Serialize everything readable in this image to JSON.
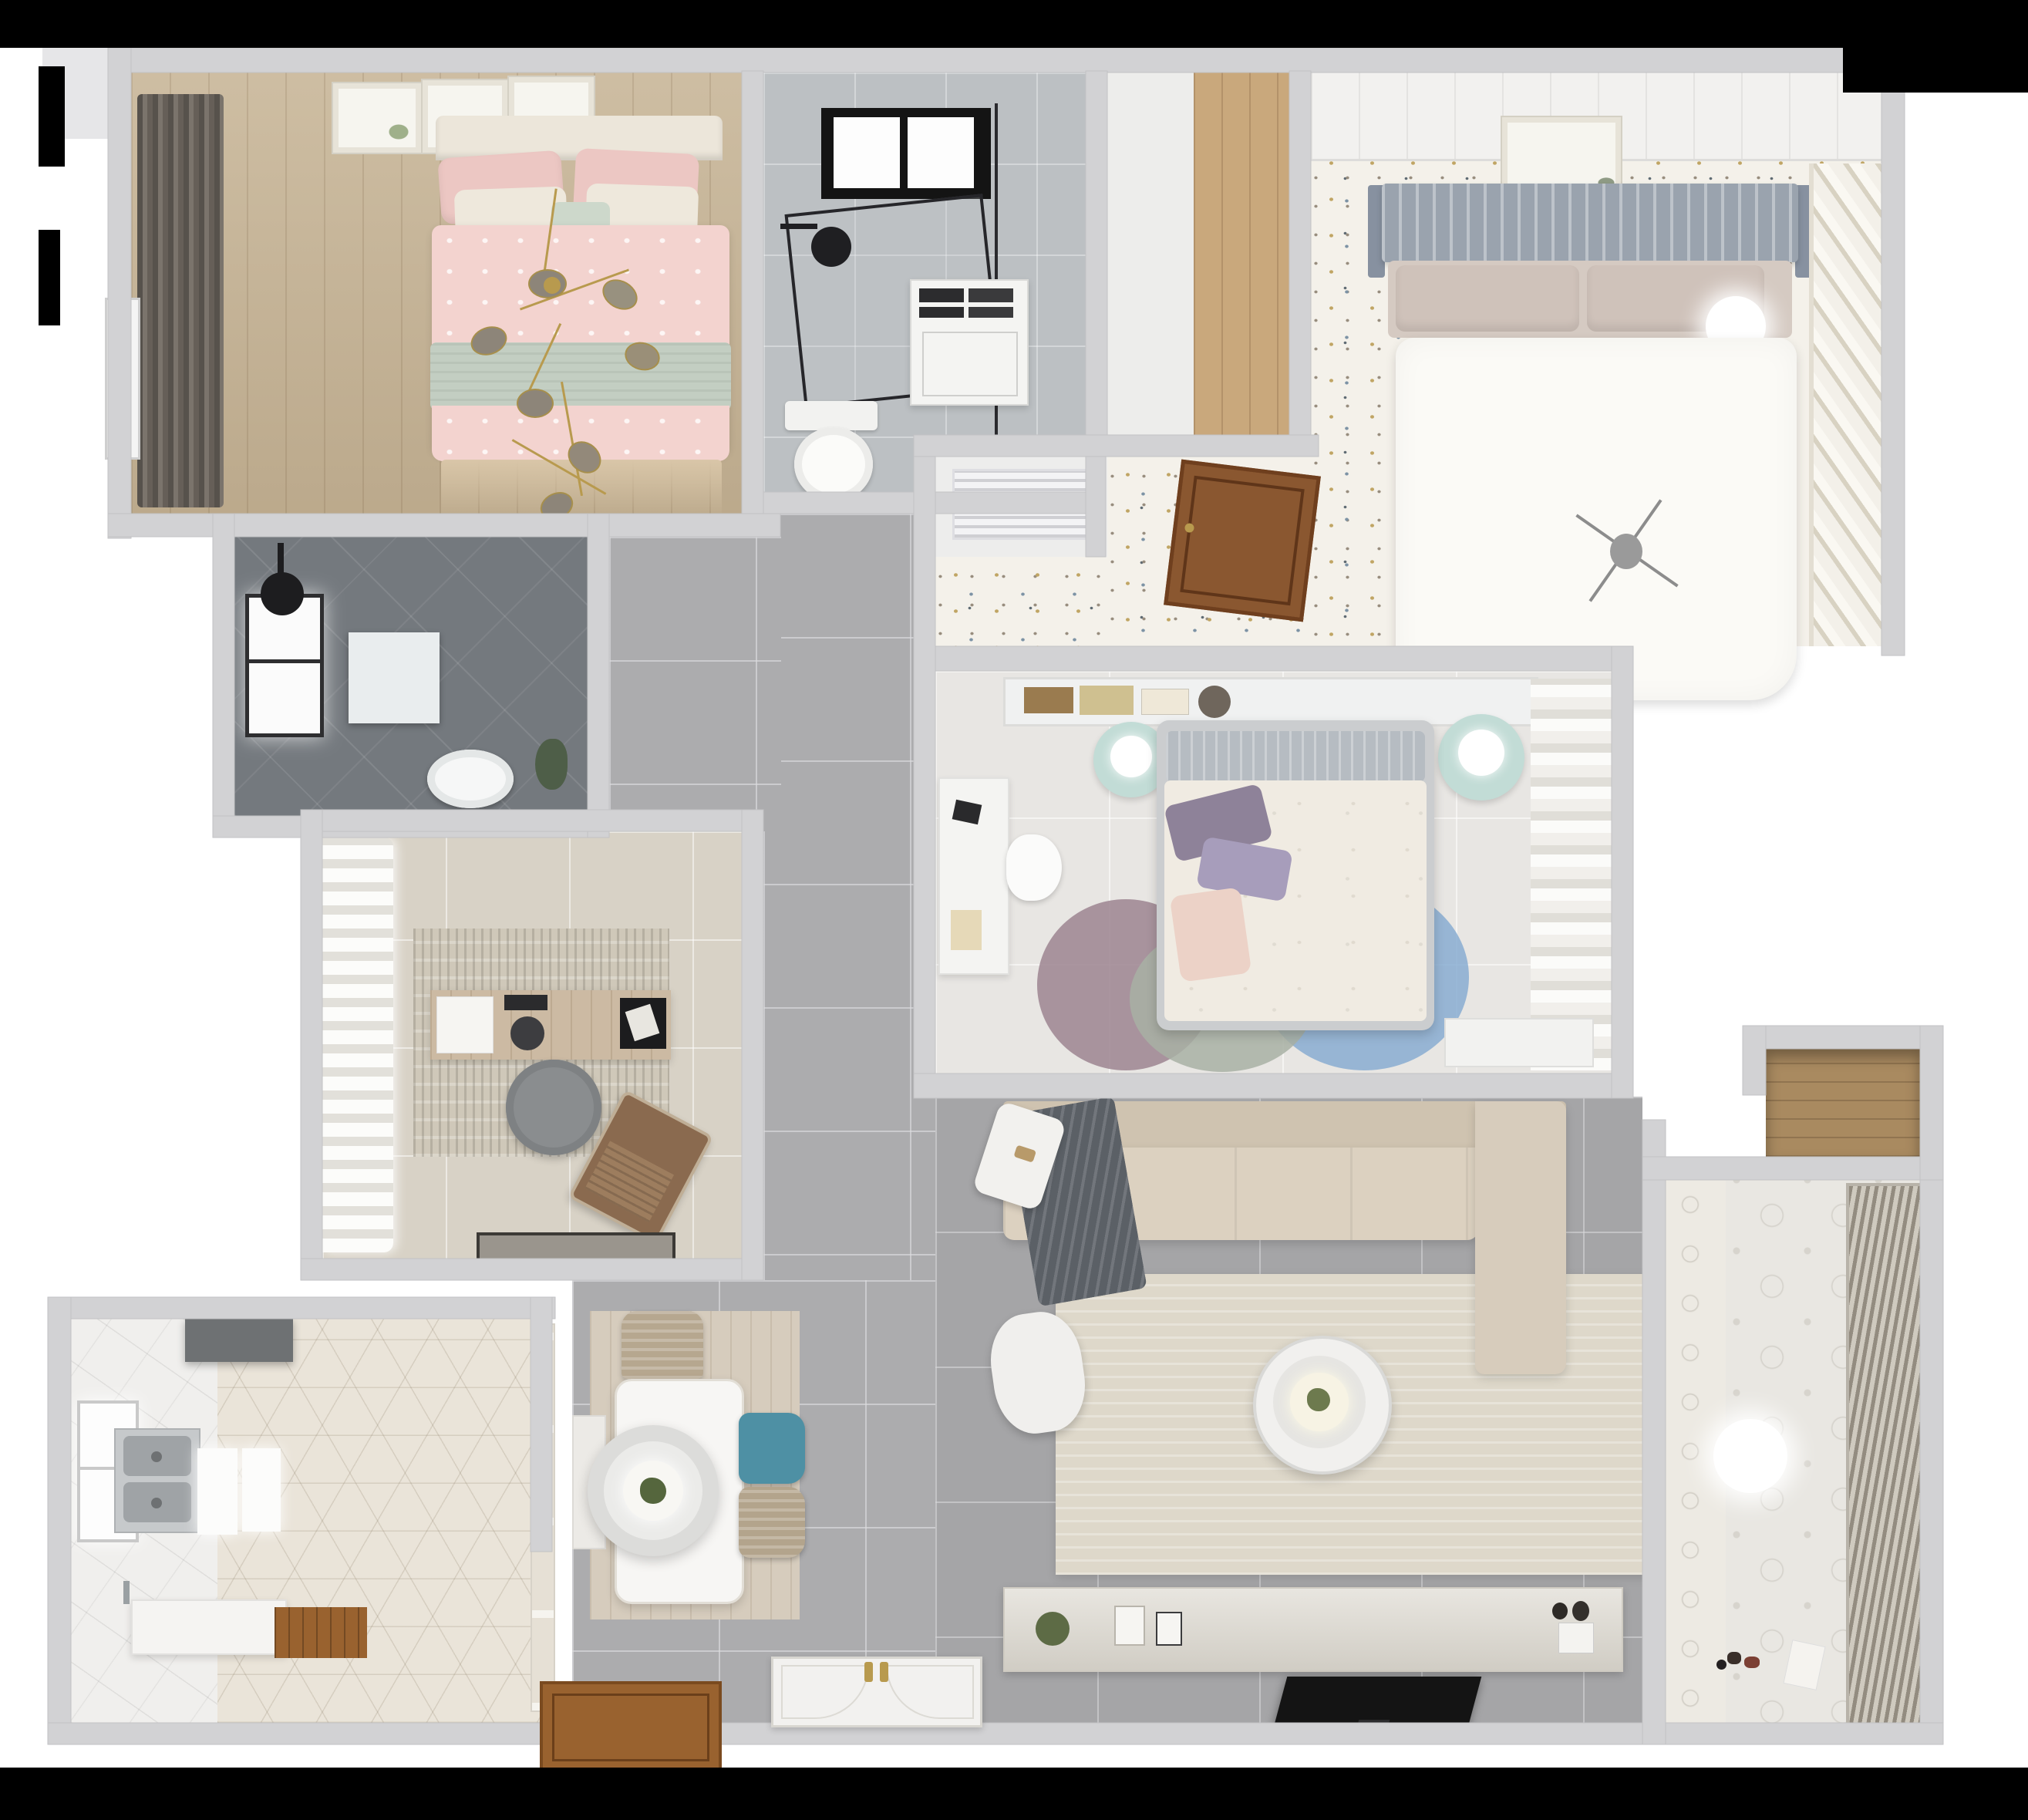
{
  "scene": {
    "type": "3d-floor-plan-render",
    "view": "top-down apartment dollhouse render",
    "background_color": "#ffffff",
    "mask_color": "#000000"
  },
  "palette": {
    "wall": "#d2d2d4",
    "wall_outline": "#c2c2c4",
    "tile_corridor": "#acacae",
    "tile_living": "#a5a5a7",
    "tile_bathroom": "#bcc0c3",
    "tile_dark_shower": "#74797e",
    "tile_white_kitchen": "#f0efed",
    "hex_kitchen": "#eae4d9",
    "wood_bedroom": "#c8b698",
    "wood_closet": "#c9a87c",
    "speckled_terrazzo": "#f4f1ea",
    "master_floor": "#e8e6e3",
    "study_floor": "#d8d2c6",
    "balcony_bath_floor": "#e9e7e2",
    "sofa_beige": "#d9cebc",
    "living_rug": "#ded8ca",
    "dining_rug": "#d6ccbd",
    "bed_pink": "#f3d3cf",
    "throw_sage": "#c3cec2",
    "duvet_white": "#fbfaf6",
    "duvet_cream": "#f0ebe2",
    "pillow_purple": "#8e8299",
    "rug_blue": "#82a9cf",
    "rug_mauve": "#9c8490",
    "rug_sage": "#a8b0a4",
    "chair_teal": "#4e90a4",
    "chair_beige": "#b5a58e",
    "mint_table": "#c2dcd6",
    "blanket_gray": "#5b6066",
    "accent_gold": "#b89a4e",
    "door_wood": "#8a5730",
    "tv_black": "#151515"
  },
  "rooms": [
    {
      "name": "Secondary bedroom with pink double bed",
      "floor": "wood",
      "furniture": [
        "double bed",
        "pink duvet",
        "sage throw",
        "pillows",
        "three wall art frames",
        "dark drapes",
        "gold branch chandelier"
      ]
    },
    {
      "name": "Main bathroom",
      "floor": "marble tile",
      "furniture": [
        "glass shower enclosure",
        "skylight window",
        "black shower head",
        "washing machine",
        "toilet"
      ]
    },
    {
      "name": "Closet hallway",
      "floor": "white + wood",
      "furniture": []
    },
    {
      "name": "Guest bedroom",
      "floor": "speckled terrazzo",
      "furniture": [
        "bed with gray slat headboard",
        "white duvet",
        "ball lamp",
        "art frame",
        "slatted wardrobe",
        "ceiling panels",
        "gray chandelier"
      ]
    },
    {
      "name": "Inner hallway",
      "floor": "white + terrazzo",
      "furniture": [
        "air-conditioning unit",
        "open wood door"
      ]
    },
    {
      "name": "Master bedroom",
      "floor": "light tile",
      "furniture": [
        "bed with cream floral duvet",
        "purple pillows",
        "headboard shelf with books",
        "two mint round nightstands with lamps",
        "three overlapping round rugs",
        "white desk and chair",
        "sheer curtain wardrobe",
        "dresser"
      ]
    },
    {
      "name": "Corridor",
      "floor": "gray tile",
      "furniture": []
    },
    {
      "name": "Study",
      "floor": "beige tile",
      "furniture": [
        "white curtains",
        "area rug",
        "wood desk",
        "gray round chair",
        "brown lounge chair",
        "laptop",
        "door mat"
      ]
    },
    {
      "name": "Shower room",
      "floor": "dark tile",
      "furniture": [
        "window",
        "black shower head",
        "shower tray",
        "toilet",
        "plant"
      ]
    },
    {
      "name": "Kitchen",
      "floor": "white tile + hexagon tile",
      "furniture": [
        "range hood",
        "double stainless sink",
        "counters",
        "island counter",
        "wood mat",
        "window",
        "glass partition door"
      ]
    },
    {
      "name": "Dining area",
      "floor": "gray tile with wood rug",
      "furniture": [
        "white dining table",
        "round layered pendant lamp with plant",
        "teal chair",
        "two beige chairs",
        "bench"
      ]
    },
    {
      "name": "Living room",
      "floor": "gray tile",
      "furniture": [
        "L-shaped beige sofa",
        "dark gray blanket",
        "cream area rug",
        "round two-tier coffee table",
        "white armchair",
        "white side stool",
        "TV console with decor",
        "flat TV"
      ]
    },
    {
      "name": "Balcony bathroom",
      "floor": "patterned tile",
      "furniture": [
        "venetian blinds window",
        "round ceiling light",
        "toys",
        "paper sheet"
      ]
    },
    {
      "name": "Storage niche",
      "floor": "wood shelf",
      "furniture": []
    },
    {
      "name": "Entry",
      "floor": "threshold",
      "furniture": [
        "ornate white entry door with gold handles"
      ]
    }
  ]
}
